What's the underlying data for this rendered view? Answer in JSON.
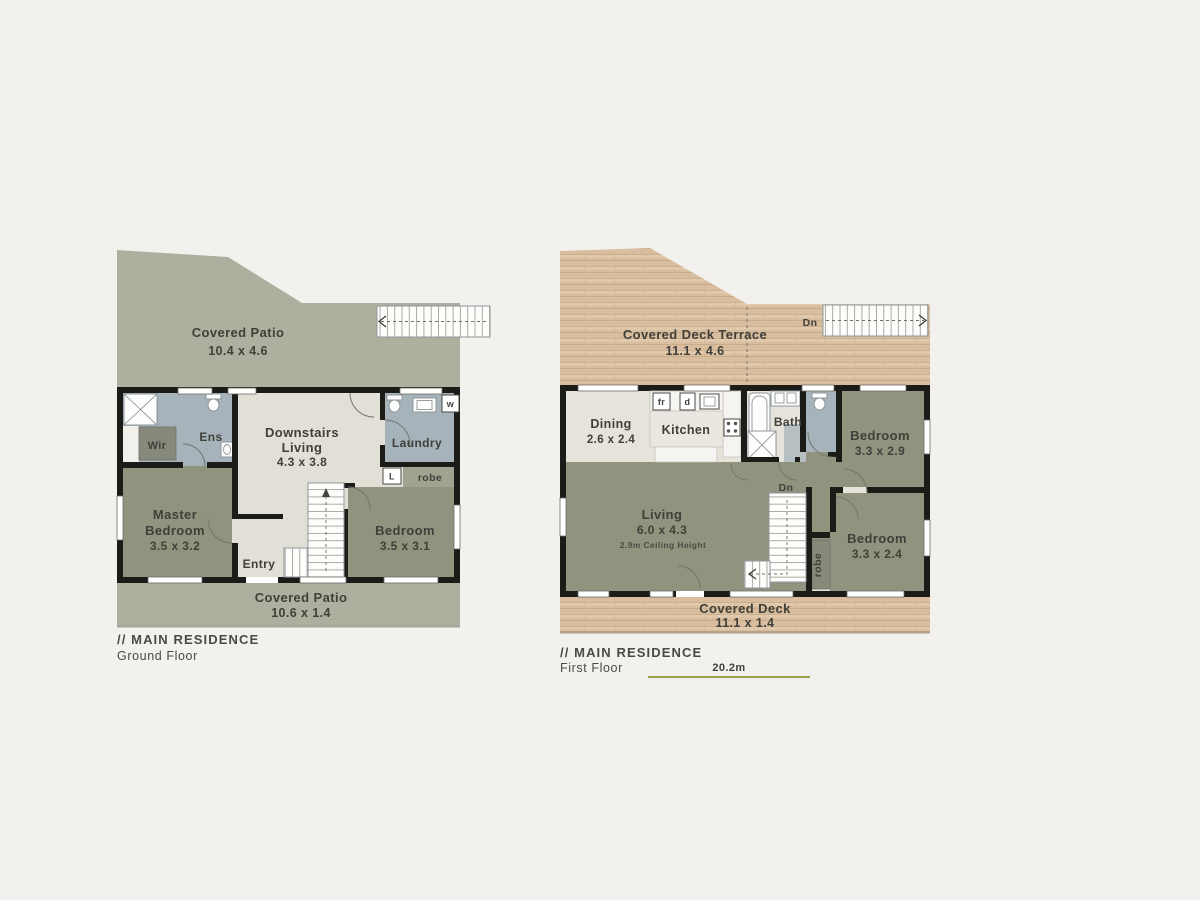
{
  "colors": {
    "page_bg": "#f2f1ee",
    "patio": "#aeaf9e",
    "interior": "#e2dfd7",
    "interior2": "#e6e3db",
    "olive": "#90937e",
    "blue": "#a6b3ba",
    "closet": "#878a7b",
    "robe_strip": "#a2a291",
    "wall": "#1b1b18",
    "wood": "#d8bd9e",
    "wood_line": "#c1a07b",
    "wood_light": "#ead8bf",
    "text": "#40403a",
    "caption": "#4a4a44",
    "scale_line": "#97a24b",
    "fixture": "#8e979c"
  },
  "ground_floor": {
    "caption1": "// MAIN RESIDENCE",
    "caption2": "Ground Floor",
    "patio_top": {
      "name": "Covered Patio",
      "dims": "10.4 x 4.6"
    },
    "patio_bottom": {
      "name": "Covered Patio",
      "dims": "10.6 x 1.4"
    },
    "wir": "Wir",
    "ens": "Ens",
    "living": {
      "line1": "Downstairs",
      "line2": "Living",
      "dims": "4.3 x 3.8"
    },
    "laundry": "Laundry",
    "washer": "w",
    "linen": "L",
    "robe": "robe",
    "master": {
      "line1": "Master",
      "line2": "Bedroom",
      "dims": "3.5 x 3.2"
    },
    "entry": "Entry",
    "bedroom": {
      "name": "Bedroom",
      "dims": "3.5 x 3.1"
    }
  },
  "first_floor": {
    "caption1": "// MAIN RESIDENCE",
    "caption2": "First Floor",
    "scale_label": "20.2m",
    "deck_terrace": {
      "name": "Covered Deck Terrace",
      "dims": "11.1 x 4.6"
    },
    "dn_terrace": "Dn",
    "dining": {
      "name": "Dining",
      "dims": "2.6 x 2.4"
    },
    "kitchen": "Kitchen",
    "fridge": "fr",
    "dishwasher": "d",
    "bath": "Bath",
    "bedroom_upper": {
      "name": "Bedroom",
      "dims": "3.3 x 2.9"
    },
    "living": {
      "name": "Living",
      "dims": "6.0 x 4.3",
      "note": "2.9m Ceiling Height"
    },
    "dn_stairs": "Dn",
    "robe": "robe",
    "bedroom_lower": {
      "name": "Bedroom",
      "dims": "3.3 x 2.4"
    },
    "deck_bottom": {
      "name": "Covered Deck",
      "dims": "11.1 x 1.4"
    }
  }
}
